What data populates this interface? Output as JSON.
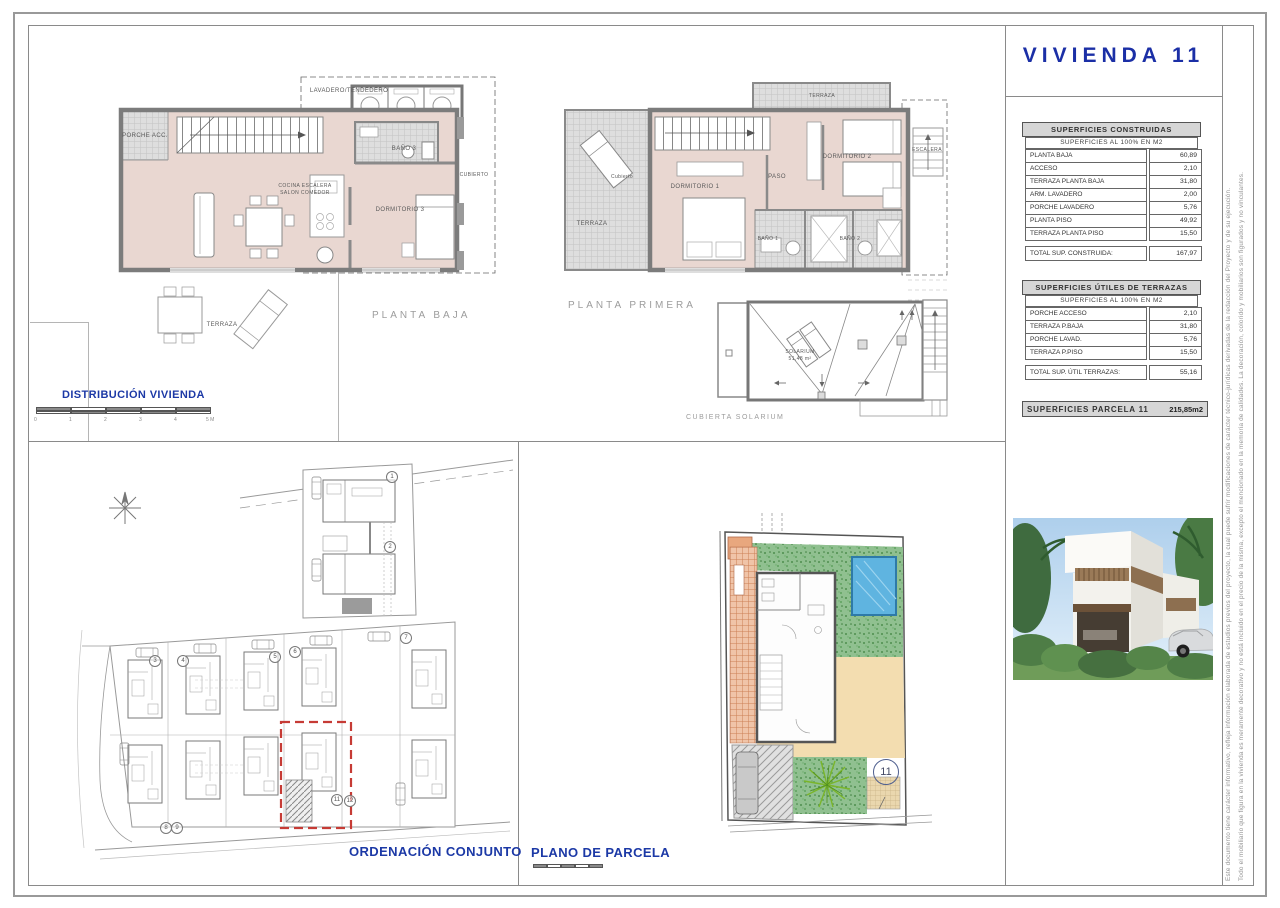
{
  "sheet": {
    "title": "VIVIENDA  11",
    "disclaimers": [
      "Este documento tiene carácter informativo, refleja información elaborada de estudios previos del proyecto, la cual puede sufrir modificaciones de carácter técnico-jurídicas derivadas de la redacción del Proyecto y de su ejecución.",
      "Todo el mobiliario que figura en la vivienda es meramente decorativo y no está incluido en el precio de la misma, excepto el mencionado en la memoria de calidades. La decoración, colorido y mobiliarios son figurados y no vinculantes."
    ]
  },
  "colors": {
    "accent_blue": "#1c39a6",
    "plan_fill": "#e9d7d1",
    "header_bg": "#d6d6d6",
    "highlight_red": "#c63b35",
    "pool_blue": "#5fb4e0",
    "garden_green": "#8cc08c",
    "sand_beige": "#f3ddb0"
  },
  "planta_baja": {
    "title": "PLANTA BAJA",
    "labels": {
      "lavadero": "LAVADERO/TENDEDERO",
      "porche": "PORCHE ACC.",
      "bano3": "BAÑO 3",
      "cubierto": "CUBIERTO",
      "cocina": "COCINA ESCALERA",
      "salon": "SALON COMEDOR",
      "dormitorio3": "DORMITORIO 3",
      "terraza": "TERRAZA"
    }
  },
  "planta_primera": {
    "title": "PLANTA PRIMERA",
    "labels": {
      "terraza_top": "TERRAZA",
      "escalera": "ESCALERA",
      "cubierto": "Cubierto",
      "terraza_left": "TERRAZA",
      "dormitorio1": "DORMITORIO 1",
      "dormitorio2": "DORMITORIO 2",
      "paso": "PASO",
      "bano1": "BAÑO 1",
      "bano2": "BAÑO 2"
    }
  },
  "solarium": {
    "title": "CUBIERTA SOLARIUM",
    "label": "SOLARIUM",
    "area": "51,48 m²"
  },
  "distribucion": {
    "label": "DISTRIBUCIÓN VIVIENDA",
    "scale_ticks": [
      "0",
      "1",
      "2",
      "3",
      "4",
      "5 M"
    ]
  },
  "site_plan": {
    "title": "ORDENACIÓN CONJUNTO",
    "plots": [
      "1",
      "2",
      "3",
      "4",
      "5",
      "6",
      "7",
      "8",
      "9",
      "11",
      "12"
    ]
  },
  "parcel_plan": {
    "title": "PLANO DE PARCELA",
    "plot_number": "11"
  },
  "tables": {
    "construidas": {
      "title": "SUPERFICIES CONSTRUIDAS",
      "subtitle": "SUPERFICIES AL 100% EN M2",
      "rows": [
        {
          "label": "PLANTA BAJA",
          "value": "60,89"
        },
        {
          "label": "ACCESO",
          "value": "2,10"
        },
        {
          "label": "TERRAZA PLANTA BAJA",
          "value": "31,80"
        },
        {
          "label": "ARM. LAVADERO",
          "value": "2,00"
        },
        {
          "label": "PORCHE LAVADERO",
          "value": "5,76"
        },
        {
          "label": "PLANTA PISO",
          "value": "49,92"
        },
        {
          "label": "TERRAZA PLANTA PISO",
          "value": "15,50"
        }
      ],
      "total_label": "TOTAL SUP. CONSTRUIDA:",
      "total_value": "167,97"
    },
    "terrazas": {
      "title": "SUPERFICIES ÚTILES DE TERRAZAS",
      "subtitle": "SUPERFICIES AL 100% EN M2",
      "rows": [
        {
          "label": "PORCHE ACCESO",
          "value": "2,10"
        },
        {
          "label": "TERRAZA P.BAJA",
          "value": "31,80"
        },
        {
          "label": "PORCHE LAVAD.",
          "value": "5,76"
        },
        {
          "label": "TERRAZA P.PISO",
          "value": "15,50"
        }
      ],
      "total_label": "TOTAL SUP. ÚTIL TERRAZAS:",
      "total_value": "55,16"
    },
    "parcela": {
      "label": "SUPERFICIES PARCELA 11",
      "value": "215,85m2"
    }
  }
}
